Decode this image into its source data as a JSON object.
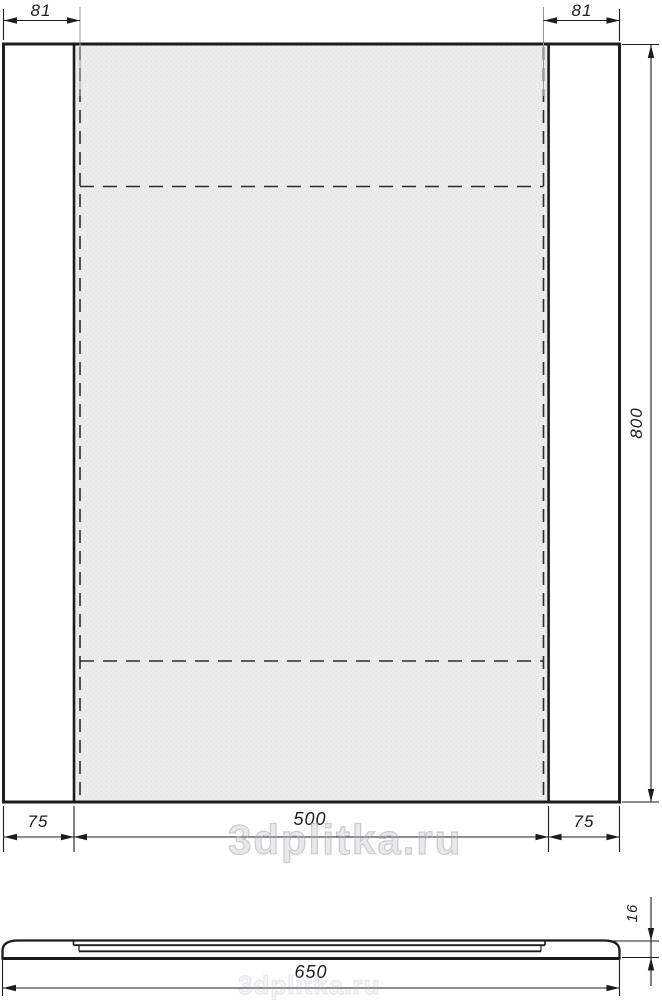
{
  "drawing": {
    "front_view": {
      "dim_top_left": "81",
      "dim_top_right": "81",
      "dim_height": "800",
      "dim_bottom_left": "75",
      "dim_bottom_center": "500",
      "dim_bottom_right": "75"
    },
    "side_view": {
      "dim_width": "650",
      "dim_thickness": "16"
    }
  },
  "watermark": {
    "text": "3dplitka.ru"
  },
  "colors": {
    "line": "#1c1c1c",
    "mirror_fill": "#ececec",
    "dashed_line": "#2b2b2b",
    "extension_gray": "#979797",
    "watermark": "#c8ccd2",
    "background": "#ffffff"
  }
}
